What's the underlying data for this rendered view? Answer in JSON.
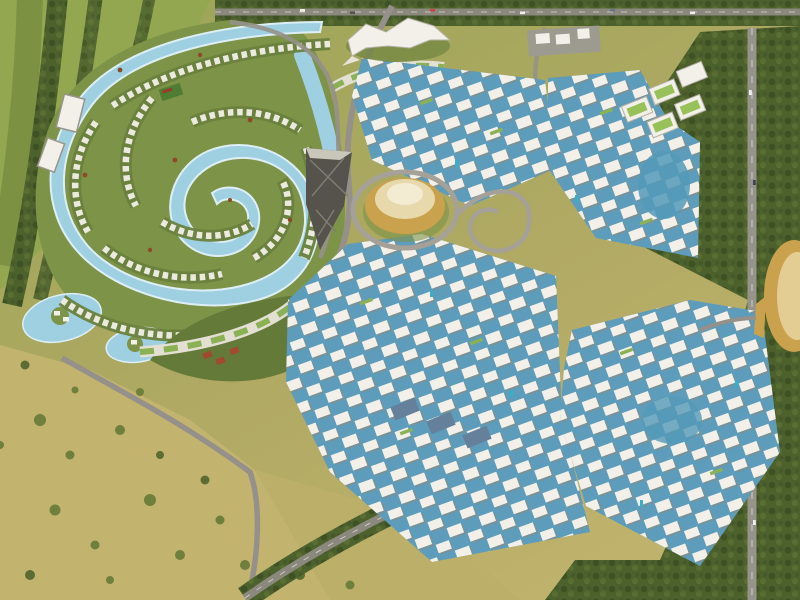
{
  "meta": {
    "type": "aerial-masterplan-render",
    "description": "Bird's-eye 3D rendering of a large mixed-use waterfront master-planned community: a winding crystal-lagoon villa district in the upper left, dense clusters of white mid-rise towers built over blue canals in the center and right, a golden cone landmark dome, a bird/falcon-shaped pavilion, big-box retail with green roofs, tree-lined boulevards and highways, and open desert-scrub fields in the lower left.",
    "visible_text": "none"
  },
  "palette": {
    "sand_base": "#b0a963",
    "field_light": "#c2b46f",
    "golf_green": "#92a750",
    "grass_green": "#7d9348",
    "tree_dark": "#47592a",
    "tree_olive": "#66773a",
    "tree_rust": "#8d4a28",
    "lagoon_blue": "#9fd0e2",
    "lagoon_shore": "#ddeef5",
    "canal_blue": "#5d9cba",
    "pool_teal": "#35b0c9",
    "building_white": "#f2f0e9",
    "building_shadow": "#98948a",
    "roof_green": "#8ab254",
    "roof_slate": "#64809a",
    "road_gray": "#95918a",
    "gold": "#caa24e",
    "gold_light": "#f4ecd2",
    "lattice_dark": "#55534c",
    "court_red": "#a04a30"
  },
  "regions": [
    {
      "id": "villa-lagoon-district",
      "desc": "winding swimmable lagoon maze ringed by rows of white villas and landscaped islands"
    },
    {
      "id": "tower-cluster-north",
      "desc": "white residential towers north of the golden dome, on blue canals"
    },
    {
      "id": "tower-cluster-east",
      "desc": "white residential towers around a central blue lagoon, east side"
    },
    {
      "id": "tower-cluster-central-south",
      "desc": "largest downtown block of white towers and canals"
    },
    {
      "id": "tower-cluster-southeast",
      "desc": "southeast block of white towers with courtyard pools"
    },
    {
      "id": "retail-sheds",
      "desc": "big-box retail buildings with green roofs, northeast"
    },
    {
      "id": "desert-field",
      "desc": "open olive-tan scrubland with scattered trees, southwest"
    },
    {
      "id": "golf-greenbelt",
      "desc": "green fairways and tree lines, northwest corner"
    },
    {
      "id": "grand-boulevard",
      "desc": "tree-lined diagonal avenue separating city from desert"
    },
    {
      "id": "right-highway",
      "desc": "vertical highway with forest belts on the east edge"
    },
    {
      "id": "top-highway",
      "desc": "horizontal road with traffic along the top edge"
    }
  ],
  "landmarks": [
    {
      "id": "falcon-pavilion",
      "desc": "white bird/falcon-shaped roof structure, top center"
    },
    {
      "id": "golden-dome",
      "desc": "golden truncated-cone auditorium with ring road"
    },
    {
      "id": "lattice-pavilion",
      "desc": "dark diamond-lattice sculptural cone"
    },
    {
      "id": "crescent-building",
      "desc": "curved green-roofed podium buildings"
    },
    {
      "id": "golden-gate",
      "desc": "golden elliptical gateway dome at the east edge"
    },
    {
      "id": "sports-courts",
      "desc": "red tennis courts in central park"
    }
  ]
}
